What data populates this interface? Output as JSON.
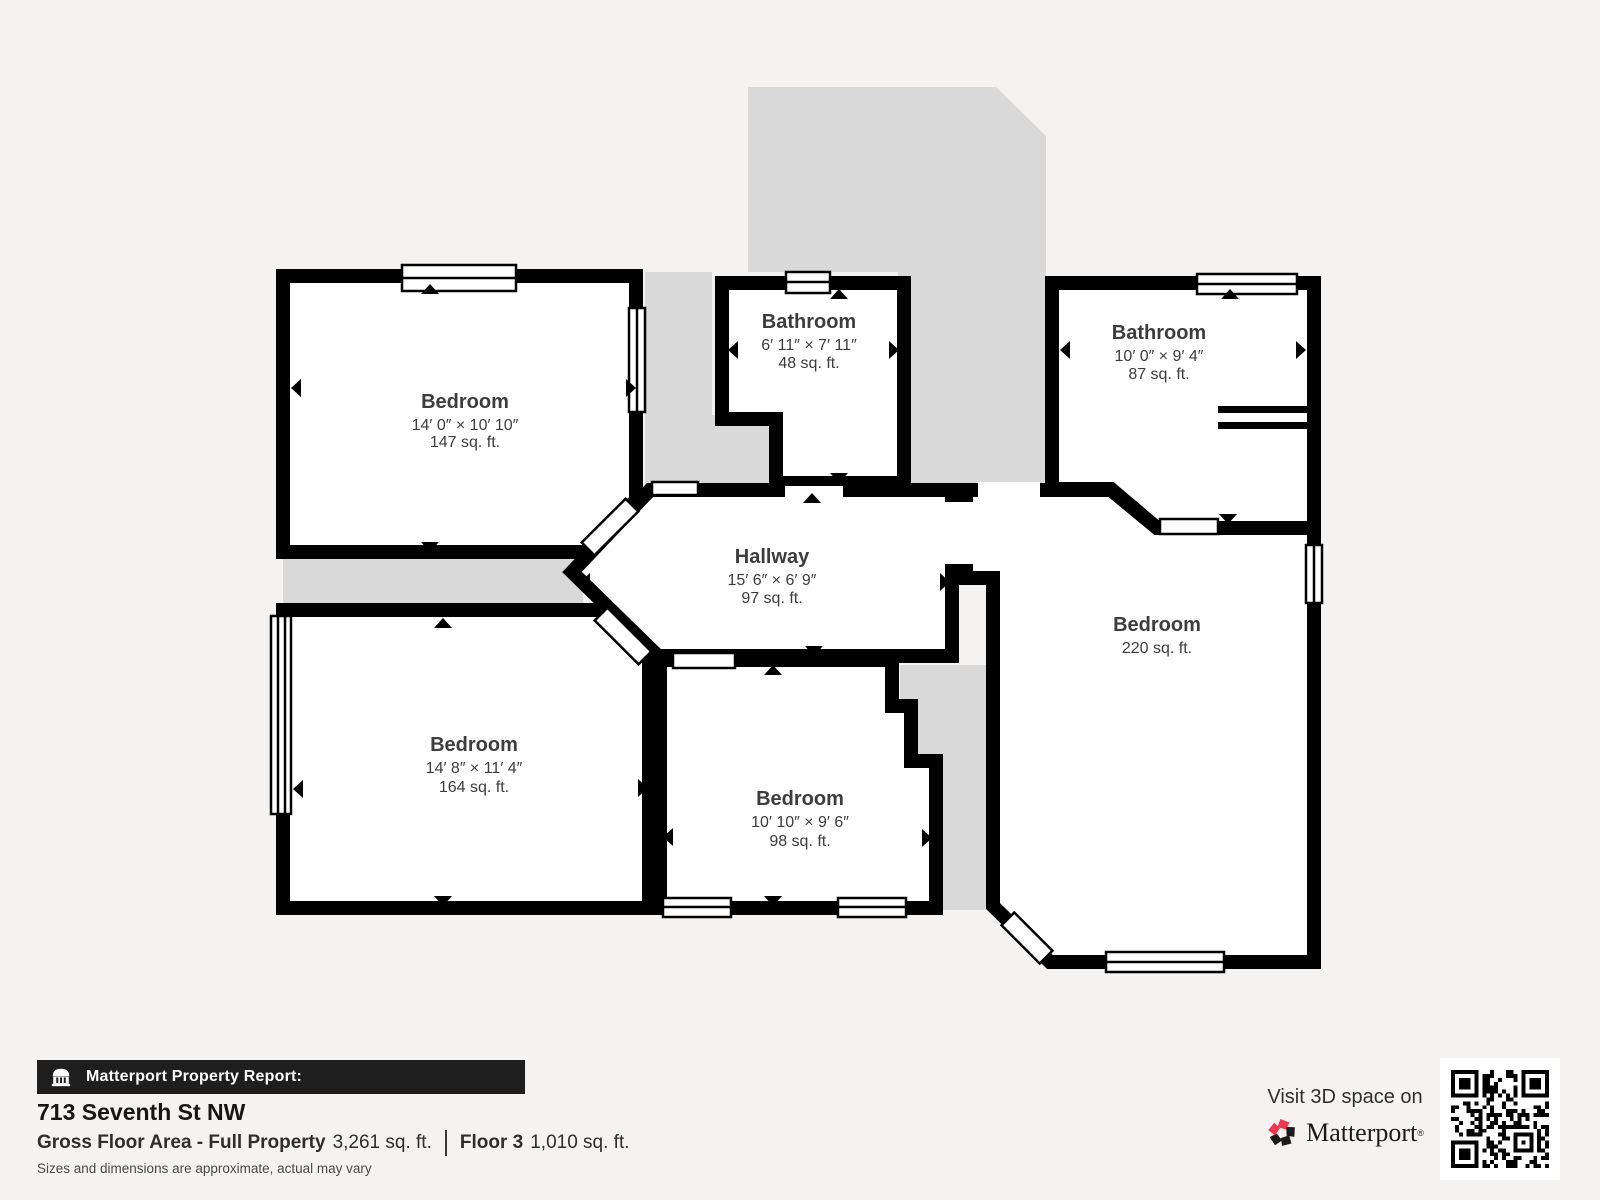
{
  "colors": {
    "background": "#f4f3f1",
    "unexplored_gray": "#d9d9d9",
    "wall": "#000000",
    "room_text": "#3d3d3d",
    "bar_bg": "#1e1e1e",
    "brand_pink": "#f4364c"
  },
  "rooms": [
    {
      "id": "bedroom-top-left",
      "name": "Bedroom",
      "dims": "14′ 0″ × 10′ 10″",
      "area": "147 sq. ft."
    },
    {
      "id": "bathroom-top",
      "name": "Bathroom",
      "dims": "6′ 11″ × 7′ 11″",
      "area": "48 sq. ft."
    },
    {
      "id": "bathroom-right",
      "name": "Bathroom",
      "dims": "10′ 0″ × 9′ 4″",
      "area": "87 sq. ft."
    },
    {
      "id": "hallway",
      "name": "Hallway",
      "dims": "15′ 6″ × 6′ 9″",
      "area": "97 sq. ft."
    },
    {
      "id": "bedroom-bottom-left",
      "name": "Bedroom",
      "dims": "14′ 8″ × 11′ 4″",
      "area": "164 sq. ft."
    },
    {
      "id": "bedroom-bottom-middle",
      "name": "Bedroom",
      "dims": "10′ 10″ × 9′ 6″",
      "area": "98 sq. ft."
    },
    {
      "id": "bedroom-right",
      "name": "Bedroom",
      "area": "220 sq. ft."
    }
  ],
  "footer": {
    "report_label": "Matterport Property Report:",
    "address": "713 Seventh St NW",
    "gfa_label": "Gross Floor Area - Full Property",
    "gfa_value": "3,261 sq. ft.",
    "floor_label": "Floor 3",
    "floor_value": "1,010 sq. ft.",
    "disclaimer": "Sizes and dimensions are approximate, actual may vary"
  },
  "cta": {
    "visit_text": "Visit 3D space on",
    "brand": "Matterport",
    "trademark": "®"
  }
}
